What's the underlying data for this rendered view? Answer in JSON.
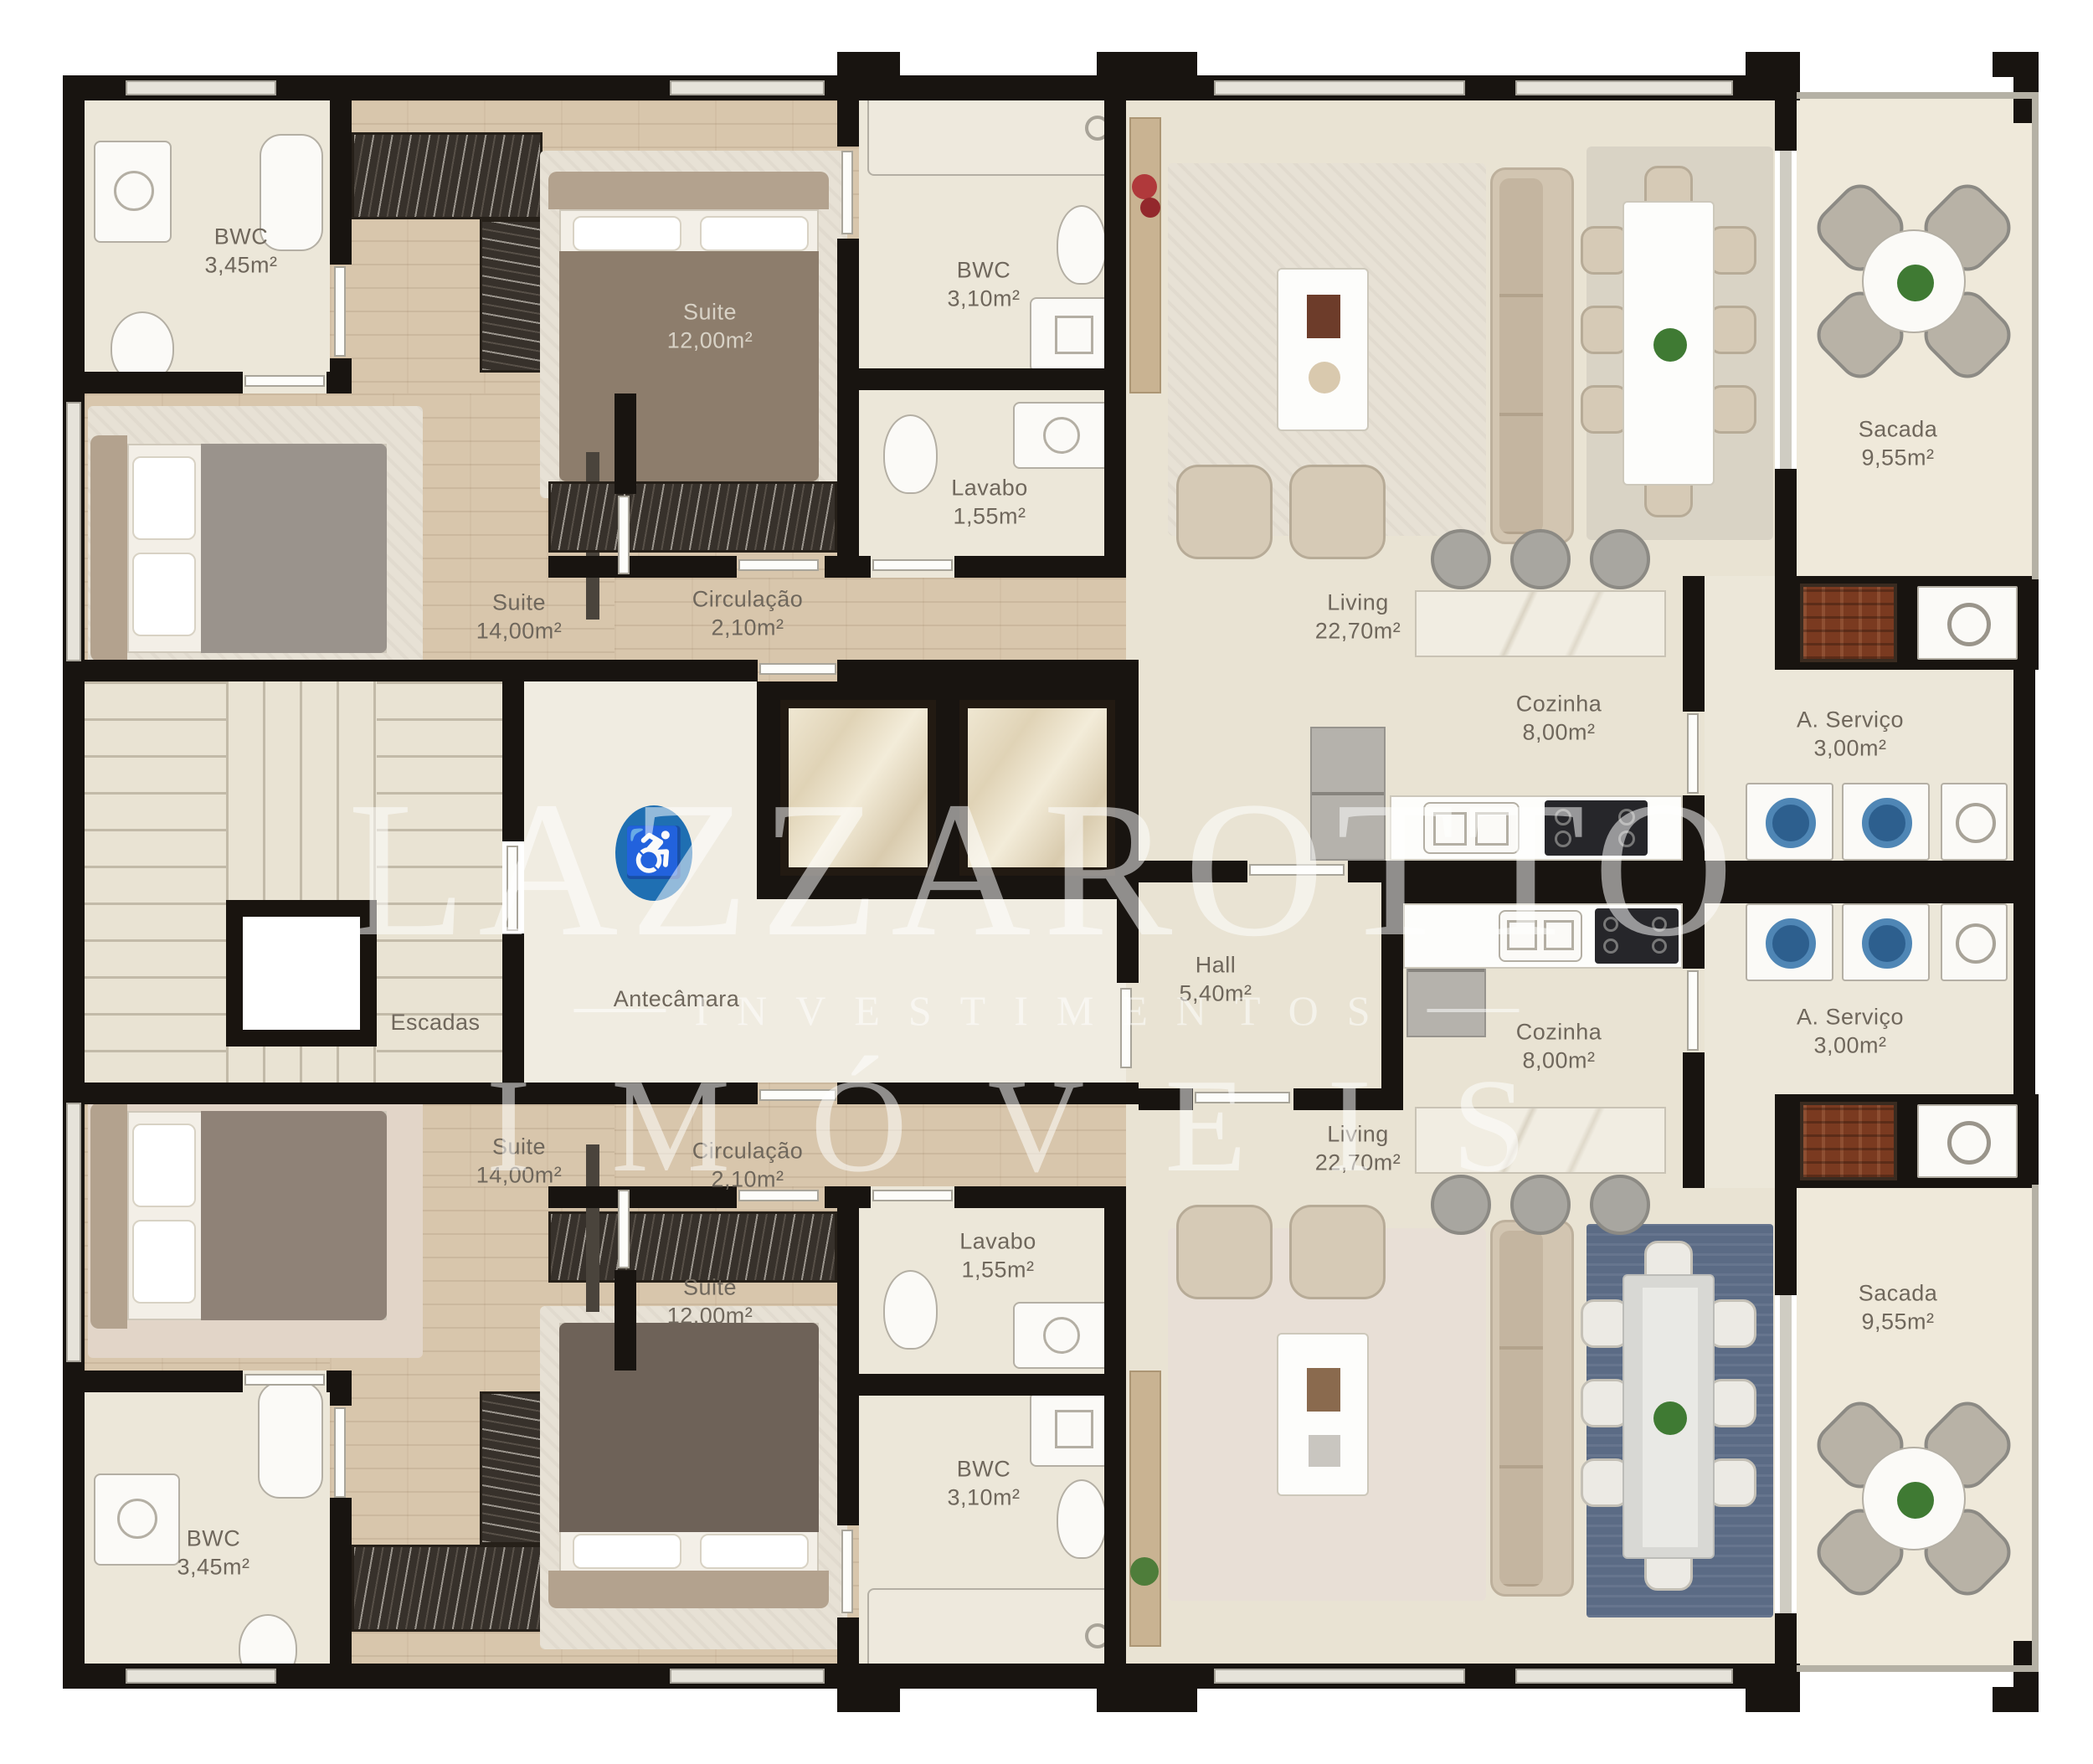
{
  "title": "Planta do pavimento - apartamentos",
  "watermark": {
    "line1": "LAZZAROTTO",
    "line2": "INVESTIMENTOS",
    "line3": "IMÓVEIS"
  },
  "icons": {
    "accessibility": "♿"
  },
  "colors": {
    "wall": "#181410",
    "floor_cream": "#e9e3d3",
    "floor_wood": "#d8c6ac",
    "accent_blue": "#1f6fb2",
    "brick": "#7a3a20",
    "rug_blue": "#5b6b85"
  },
  "rooms": {
    "bwc345_top": {
      "name": "BWC",
      "area": "3,45m²"
    },
    "suite12_top": {
      "name": "Suite",
      "area": "12,00m²"
    },
    "bwc310_top": {
      "name": "BWC",
      "area": "3,10m²"
    },
    "lavabo_top": {
      "name": "Lavabo",
      "area": "1,55m²"
    },
    "suite14_top": {
      "name": "Suite",
      "area": "14,00m²"
    },
    "circulacao_top": {
      "name": "Circulação",
      "area": "2,10m²"
    },
    "living_top": {
      "name": "Living",
      "area": "22,70m²"
    },
    "sacada_top": {
      "name": "Sacada",
      "area": "9,55m²"
    },
    "cozinha_top": {
      "name": "Cozinha",
      "area": "8,00m²"
    },
    "servico_top": {
      "name": "A. Serviço",
      "area": "3,00m²"
    },
    "escadas": {
      "name": "Escadas",
      "area": ""
    },
    "antecamara": {
      "name": "Antecâmara",
      "area": ""
    },
    "hall": {
      "name": "Hall",
      "area": "5,40m²"
    },
    "cozinha_bottom": {
      "name": "Cozinha",
      "area": "8,00m²"
    },
    "servico_bottom": {
      "name": "A. Serviço",
      "area": "3,00m²"
    },
    "suite14_bottom": {
      "name": "Suite",
      "area": "14,00m²"
    },
    "circulacao_bottom": {
      "name": "Circulação",
      "area": "2,10m²"
    },
    "living_bottom": {
      "name": "Living",
      "area": "22,70m²"
    },
    "lavabo_bottom": {
      "name": "Lavabo",
      "area": "1,55m²"
    },
    "suite12_bottom": {
      "name": "Suite",
      "area": "12,00m²"
    },
    "bwc310_bottom": {
      "name": "BWC",
      "area": "3,10m²"
    },
    "bwc345_bottom": {
      "name": "BWC",
      "area": "3,45m²"
    },
    "sacada_bottom": {
      "name": "Sacada",
      "area": "9,55m²"
    }
  }
}
